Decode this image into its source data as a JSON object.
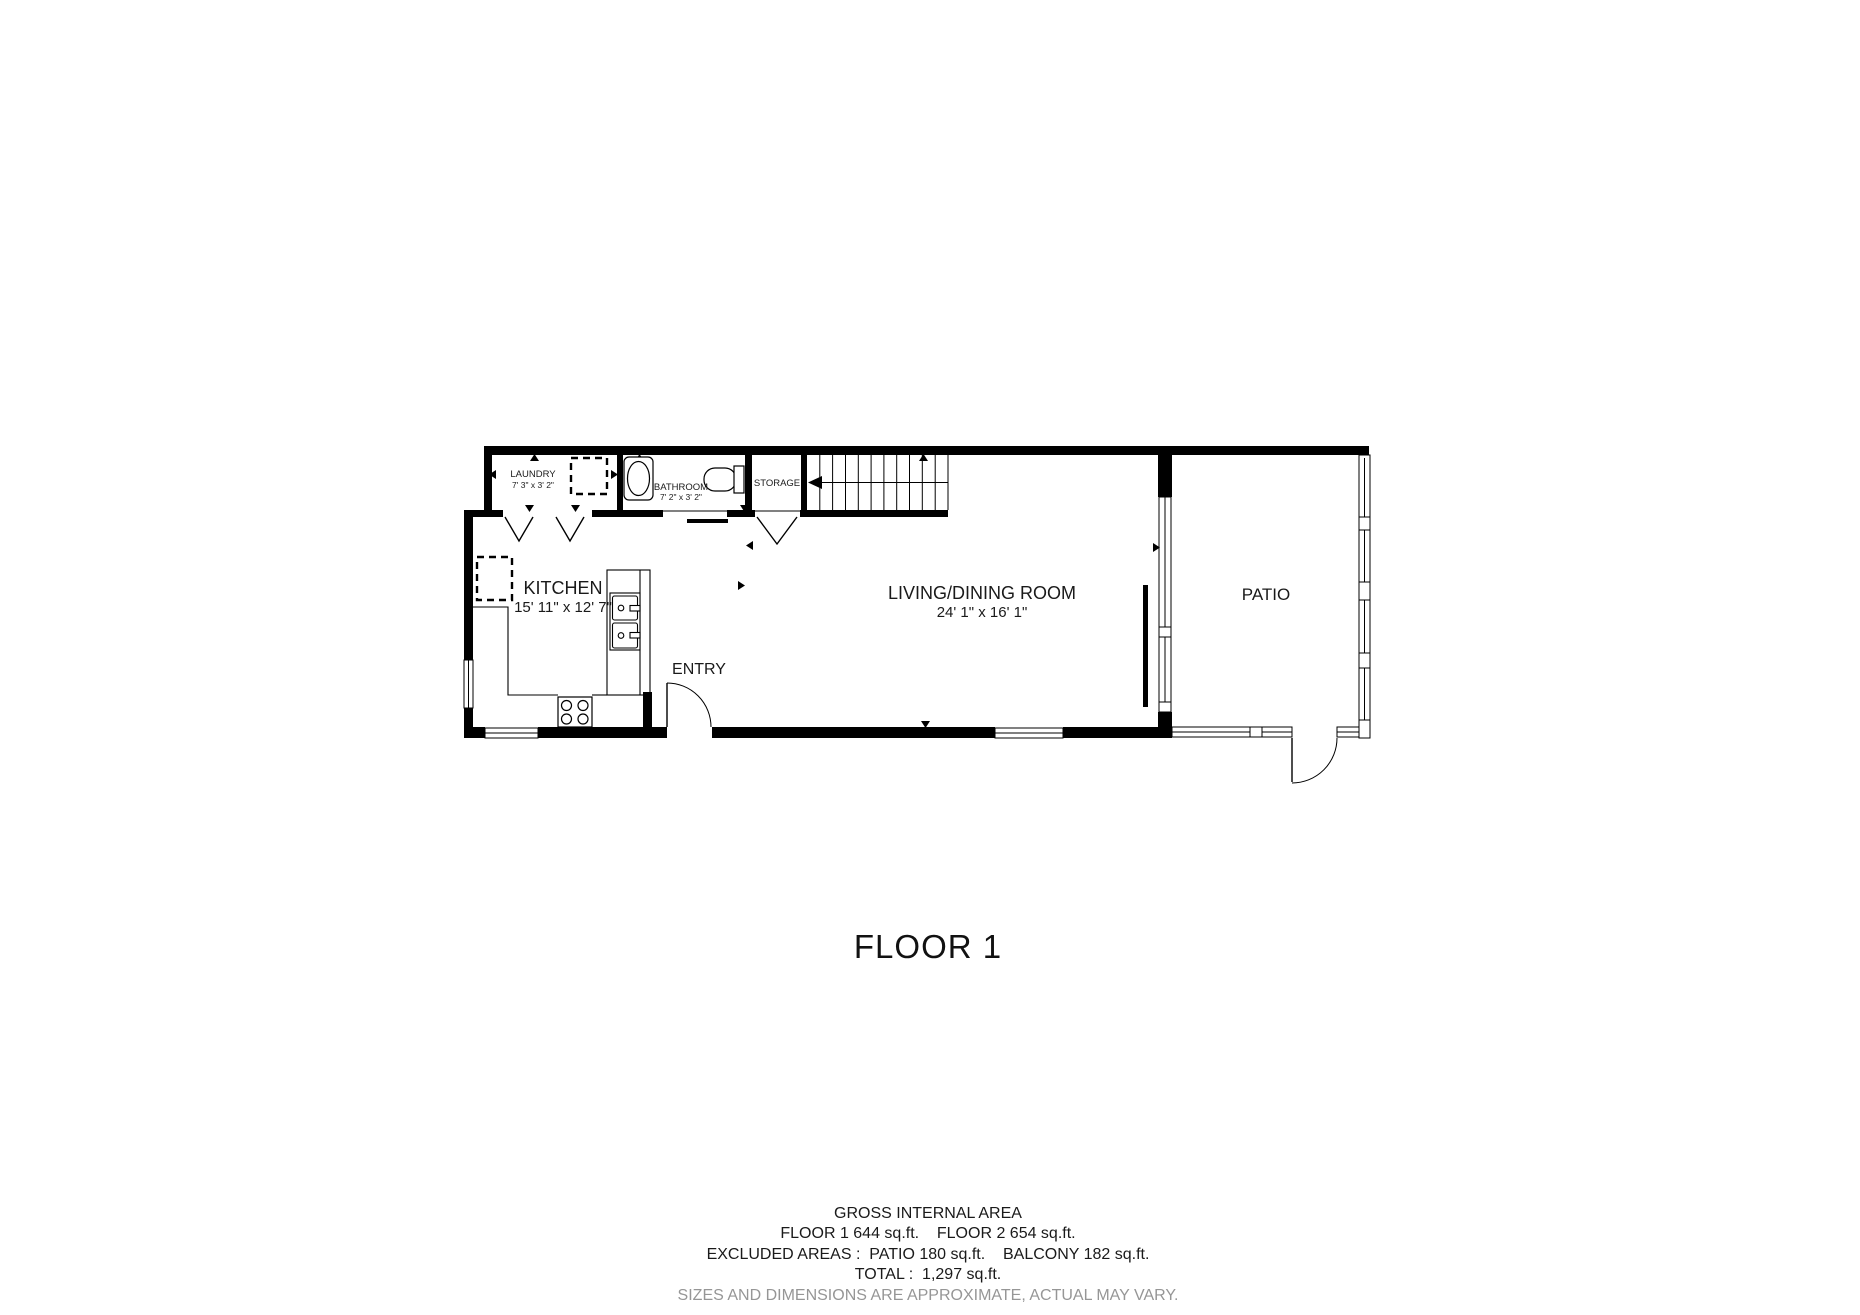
{
  "title": "FLOOR 1",
  "plan": {
    "rooms": {
      "laundry": {
        "label": "LAUNDRY",
        "dims": "7' 3\" x 3' 2\""
      },
      "bathroom": {
        "label": "BATHROOM",
        "dims": "7' 2\" x 3' 2\""
      },
      "storage": {
        "label": "STORAGE"
      },
      "kitchen": {
        "label": "KITCHEN",
        "dims": "15' 11\" x 12' 7\""
      },
      "living_dining": {
        "label": "LIVING/DINING ROOM",
        "dims": "24' 1\" x 16' 1\""
      },
      "entry": {
        "label": "ENTRY"
      },
      "patio": {
        "label": "PATIO"
      }
    }
  },
  "footer": {
    "line1": "GROSS INTERNAL AREA",
    "line2": "FLOOR 1 644 sq.ft.    FLOOR 2 654 sq.ft.",
    "line3": "EXCLUDED AREAS :  PATIO 180 sq.ft.    BALCONY 182 sq.ft.",
    "line4": "TOTAL :  1,297 sq.ft.",
    "disclaimer": "SIZES AND DIMENSIONS ARE APPROXIMATE, ACTUAL MAY VARY."
  },
  "colors": {
    "wall": "#000000",
    "text": "#1a1a1a",
    "disclaimer": "#969696"
  }
}
